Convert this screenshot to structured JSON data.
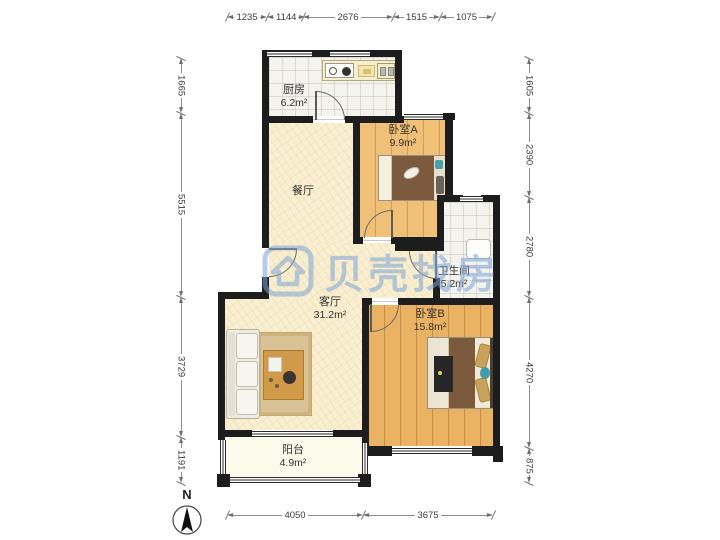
{
  "watermark": {
    "brand": "贝壳找房"
  },
  "compass": {
    "label": "N"
  },
  "rooms": {
    "kitchen": {
      "name": "厨房",
      "area": "6.2m²"
    },
    "bedroom_a": {
      "name": "卧室A",
      "area": "9.9m²"
    },
    "dining": {
      "name": "餐厅",
      "area": ""
    },
    "bathroom": {
      "name": "卫生间",
      "area": "5.2m²"
    },
    "living": {
      "name": "客厅",
      "area": "31.2m²"
    },
    "bedroom_b": {
      "name": "卧室B",
      "area": "15.8m²"
    },
    "balcony": {
      "name": "阳台",
      "area": "4.9m²"
    }
  },
  "dimensions_mm": {
    "top": [
      "1235",
      "1144",
      "2676",
      "1515",
      "1075"
    ],
    "left": [
      "1665",
      "5515",
      "3729",
      "1191"
    ],
    "right": [
      "1605",
      "2390",
      "2780",
      "4270",
      "875"
    ],
    "bottom": [
      "4050",
      "3675"
    ]
  },
  "colors": {
    "wall": "#1d1d1d",
    "floor_cream": "#f9efd2",
    "floor_wood_a": "#f1c078",
    "floor_wood_b": "#eab263",
    "floor_tile": "#f4f3ee",
    "watermark_blue": "#7ca4d8"
  }
}
